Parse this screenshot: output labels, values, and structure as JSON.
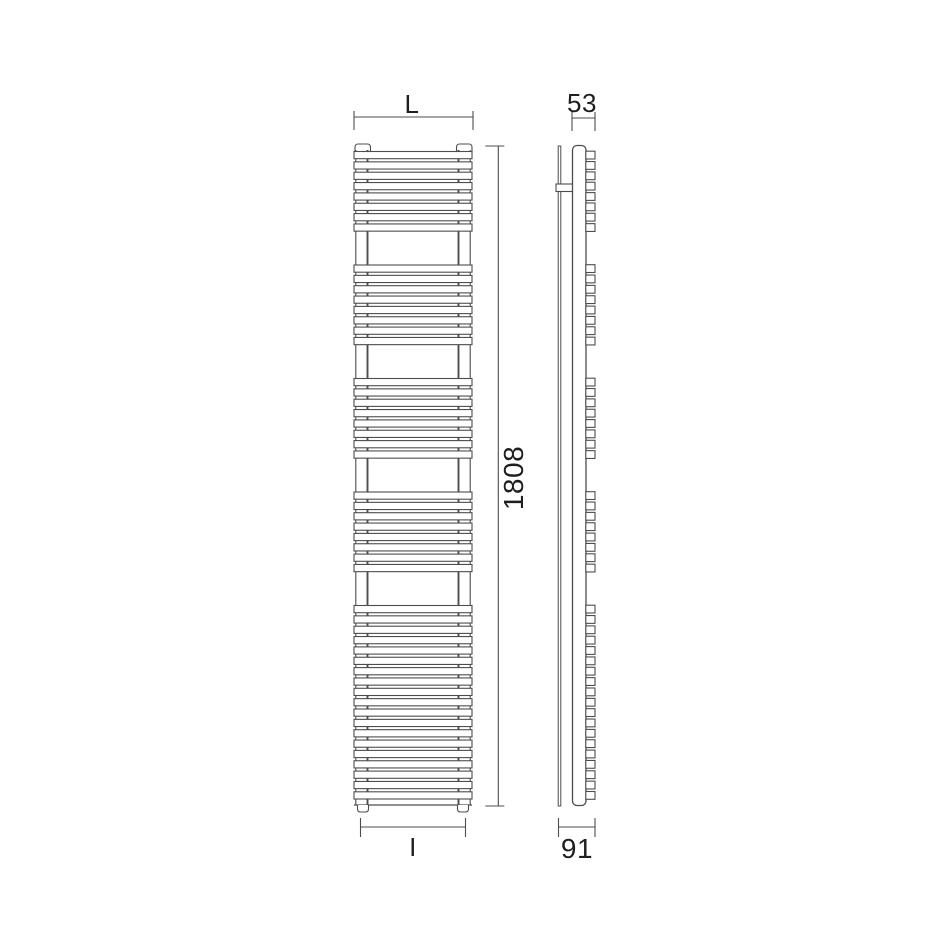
{
  "drawing": {
    "title_labels": {
      "front_width_top": "L",
      "side_depth_top": "53",
      "front_height": "1808",
      "front_width_bottom": "I",
      "side_depth_bottom": "91"
    },
    "style": {
      "background": "#ffffff",
      "line_color": "#4d4d4d",
      "thin_line": 1.1,
      "main_line": 1.3,
      "fill": "#ffffff",
      "text_color": "#1f1f1f"
    },
    "front_view": {
      "tubes_x0": 354,
      "tubes_x1": 472,
      "tube_height": 7.2,
      "tube_period": 10.35,
      "group_starts": [
        151.5,
        265,
        378.5,
        492,
        605.5
      ],
      "group_counts": [
        8,
        8,
        8,
        8,
        19
      ],
      "body_top": 150,
      "body_bottom": 805,
      "collector_lines_x": [
        355.8,
        367.5,
        458.5,
        470.2
      ],
      "caps": [
        {
          "x": 355,
          "w": 15.5
        },
        {
          "x": 456.5,
          "w": 15.5
        }
      ],
      "cap_top": 144,
      "cap_height": 9,
      "feet": [
        {
          "x": 357.5,
          "w": 11
        },
        {
          "x": 457.5,
          "w": 11
        }
      ],
      "foot_height": 7
    },
    "side_view": {
      "bracket_x": 558.2,
      "bracket_w": 2.6,
      "top": 146,
      "bottom": 806,
      "arm": {
        "x": 556,
        "y": 184,
        "w": 17,
        "h": 7.5
      },
      "body": {
        "x": 572.5,
        "w": 13.5,
        "rx": 4.5
      },
      "fin_x": 585.8,
      "fin_w": 9.2,
      "fin_h": 7.8
    },
    "dimensions": [
      {
        "id": "L",
        "orient": "h",
        "x1": 354,
        "x2": 473,
        "y": 117,
        "tick_a": 6,
        "tick_b": 13
      },
      {
        "id": "53",
        "orient": "h",
        "x1": 572,
        "x2": 595,
        "y": 118,
        "tick_a": 6,
        "tick_b": 13
      },
      {
        "id": "1808",
        "orient": "v",
        "x": 498.3,
        "y1": 146,
        "y2": 806,
        "tick_a": 13,
        "tick_b": 6
      },
      {
        "id": "I",
        "orient": "h",
        "x1": 360.5,
        "x2": 465.5,
        "y": 827,
        "tick_a": 9,
        "tick_b": 10
      },
      {
        "id": "91",
        "orient": "h",
        "x1": 558.5,
        "x2": 595,
        "y": 827,
        "tick_a": 9,
        "tick_b": 10
      }
    ]
  }
}
